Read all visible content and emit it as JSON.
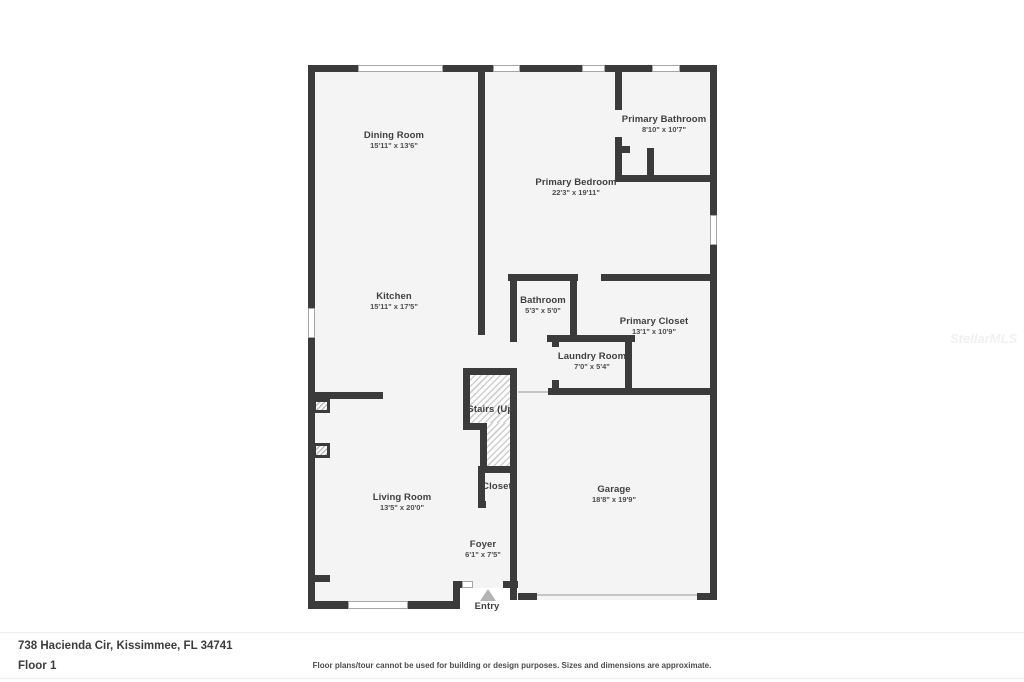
{
  "plan": {
    "rooms": [
      {
        "name": "Dining Room",
        "dims": "15'11\" x 13'6\""
      },
      {
        "name": "Primary Bathroom",
        "dims": "8'10\" x 10'7\""
      },
      {
        "name": "Primary Bedroom",
        "dims": "22'3\" x 19'11\""
      },
      {
        "name": "Kitchen",
        "dims": "15'11\" x 17'5\""
      },
      {
        "name": "Bathroom",
        "dims": "5'3\" x 5'0\""
      },
      {
        "name": "Primary Closet",
        "dims": "13'1\" x 10'9\""
      },
      {
        "name": "Laundry Room",
        "dims": "7'0\" x 5'4\""
      },
      {
        "name": "Stairs (Up)",
        "dims": ""
      },
      {
        "name": "Closet",
        "dims": ""
      },
      {
        "name": "Living Room",
        "dims": "13'5\" x 20'0\""
      },
      {
        "name": "Garage",
        "dims": "18'8\" x 19'9\""
      },
      {
        "name": "Foyer",
        "dims": "6'1\" x 7'5\""
      },
      {
        "name": "Entry",
        "dims": ""
      }
    ],
    "colors": {
      "wall": "#3b3b3b",
      "floor": "#f4f4f4",
      "window": "#ffffff",
      "entry_marker": "#b3b3b3"
    }
  },
  "watermark": "StellarMLS",
  "footer": {
    "address": "738 Hacienda Cir, Kissimmee, FL 34741",
    "floor_label": "Floor 1",
    "disclaimer": "Floor plans/tour cannot be used for building or design purposes. Sizes and dimensions are approximate."
  }
}
